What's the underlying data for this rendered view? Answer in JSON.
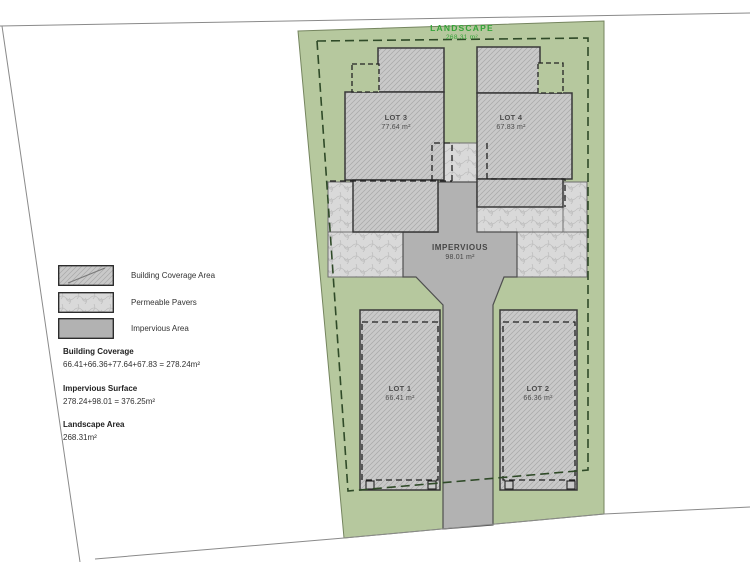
{
  "site_plan": {
    "landscape": {
      "label": "LANDSCAPE",
      "area": "268.31 m²"
    },
    "impervious": {
      "label": "IMPERVIOUS",
      "area": "98.01 m²"
    },
    "lots": [
      {
        "name": "LOT 1",
        "area": "66.41 m²"
      },
      {
        "name": "LOT 2",
        "area": "66.36 m²"
      },
      {
        "name": "LOT 3",
        "area": "77.64 m²"
      },
      {
        "name": "LOT 4",
        "area": "67.83 m²"
      }
    ]
  },
  "legend": {
    "items": [
      {
        "label": "Building Coverage Area",
        "swatch": "building-hatch"
      },
      {
        "label": "Permeable Pavers",
        "swatch": "permeable-pavers"
      },
      {
        "label": "Impervious Area",
        "swatch": "impervious"
      }
    ]
  },
  "calculations": [
    {
      "title": "Building Coverage",
      "formula": "66.41+66.36+77.64+67.83 = 278.24m²"
    },
    {
      "title": "Impervious Surface",
      "formula": "278.24+98.01 = 376.25m²"
    },
    {
      "title": "Landscape Area",
      "formula": "268.31m²"
    }
  ],
  "colors": {
    "landscape_green": "#b6c89e",
    "landscape_text_green": "#35a339",
    "building_fill": "#c9c9c9",
    "paver_fill": "#d9d9d9",
    "impervious_fill": "#b2b2b2",
    "boundary_dash": "#2f4a28"
  }
}
